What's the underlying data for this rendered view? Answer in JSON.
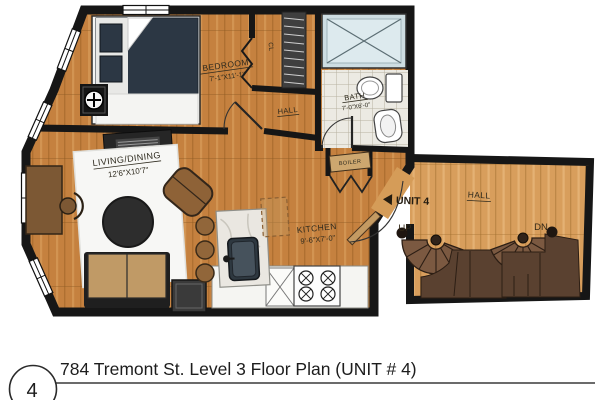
{
  "title_block": {
    "sheet_number": "4",
    "title": "784 Tremont St. Level 3 Floor Plan (UNIT # 4)"
  },
  "labels": {
    "bedroom": {
      "name": "BEDROOM",
      "dims": "7'-1\"X11'-1\""
    },
    "living_dining": {
      "name": "LIVING/DINING",
      "dims": "12'6\"X10'7\""
    },
    "kitchen": {
      "name": "KITCHEN",
      "dims": "9'-6\"X7'-0\""
    },
    "bath": {
      "name": "BATH",
      "dims": "7'-0\"X6'-0\""
    },
    "hall_main": {
      "name": "HALL"
    },
    "hall_stairs": {
      "name": "HALL"
    },
    "closet": {
      "name": "CL"
    },
    "boiler": {
      "name": "BOILER"
    },
    "unit": {
      "name": "UNIT 4"
    },
    "stairs_up": {
      "name": "UP"
    },
    "stairs_down": {
      "name": "DN"
    }
  },
  "colors": {
    "wall": "#161616",
    "wood_main": "#c5813f",
    "wood_hall": "#d89e5c",
    "tile": "#eceae3",
    "tub": "#cddde2",
    "bed": "#2c3744",
    "rug": "#f7f7f5",
    "stairs": "#7b5941",
    "stairs_landing": "#5a4130",
    "sofa": "#c09a66",
    "counter": "#f5f5f2"
  }
}
